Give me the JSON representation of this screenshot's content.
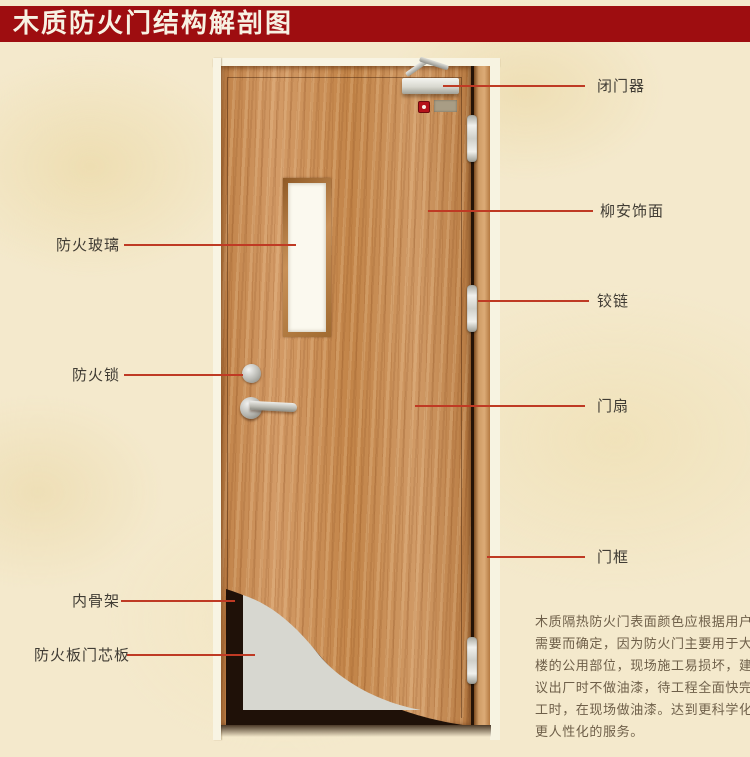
{
  "title": {
    "text": "木质防火门结构解剖图"
  },
  "callouts": {
    "fire_glass": "防火玻璃",
    "fire_lock": "防火锁",
    "inner_skeleton": "内骨架",
    "fire_board_core": "防火板门芯板",
    "door_closer": "闭门器",
    "lauan_veneer": "柳安饰面",
    "hinge": "铰链",
    "door_leaf": "门扇",
    "door_frame": "门框"
  },
  "description": {
    "text": "木质隔热防火门表面颜色应根据用户需要而确定，因为防火门主要用于大楼的公用部位，现场施工易损坏，建议出厂时不做油漆，待工程全面快完工时，在现场做油漆。达到更科学化更人性化的服务。"
  },
  "colors": {
    "banner_bg": "#9e0d10",
    "banner_text": "#f7f1e3",
    "leader_line": "#bf3a24",
    "label_text": "#403c34",
    "page_bg": "#f4e9cc",
    "wood": "#c98e58",
    "door_frame_white": "#f8f4e3",
    "core_panel_grey": "#d7d7d0",
    "cutaway_dark": "#1f1108",
    "paragraph_text": "#6e5f49",
    "metal": "#d9d9d3",
    "alarm_red": "#b5121a"
  }
}
